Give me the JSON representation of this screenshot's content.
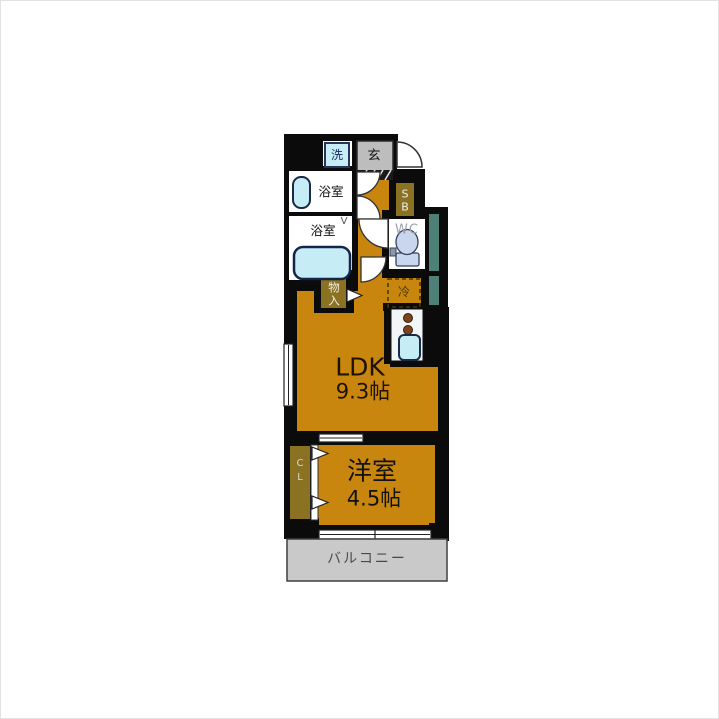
{
  "plan": {
    "type": "apartment-floor-plan",
    "rooms": {
      "washer": {
        "label": "洗"
      },
      "entrance": {
        "label": "玄"
      },
      "washroom": {
        "label": "浴室"
      },
      "bathroom": {
        "label": "浴室"
      },
      "vent_mark": {
        "label": "V"
      },
      "shoe_box": {
        "line1": "S",
        "line2": "B"
      },
      "toilet": {
        "label": "WC"
      },
      "storage": {
        "line1": "物",
        "line2": "入"
      },
      "fridge": {
        "label": "冷"
      },
      "ldk": {
        "label": "LDK",
        "size": "9.3帖"
      },
      "closet": {
        "line1": "C",
        "line2": "L"
      },
      "western_room": {
        "label": "洋室",
        "size": "4.5帖"
      },
      "balcony": {
        "label": "バルコニー"
      }
    },
    "colors": {
      "wall": "#0b0b0b",
      "floor_orange": "#c8860f",
      "cabinet_olive": "#8a7222",
      "fixture_cyan": "#c6edf5",
      "toilet_blue": "#c9d6ee",
      "entry_gray": "#bdbdbd",
      "balcony_gray": "#c9c9c9",
      "shaft_teal": "#4f8077"
    }
  }
}
